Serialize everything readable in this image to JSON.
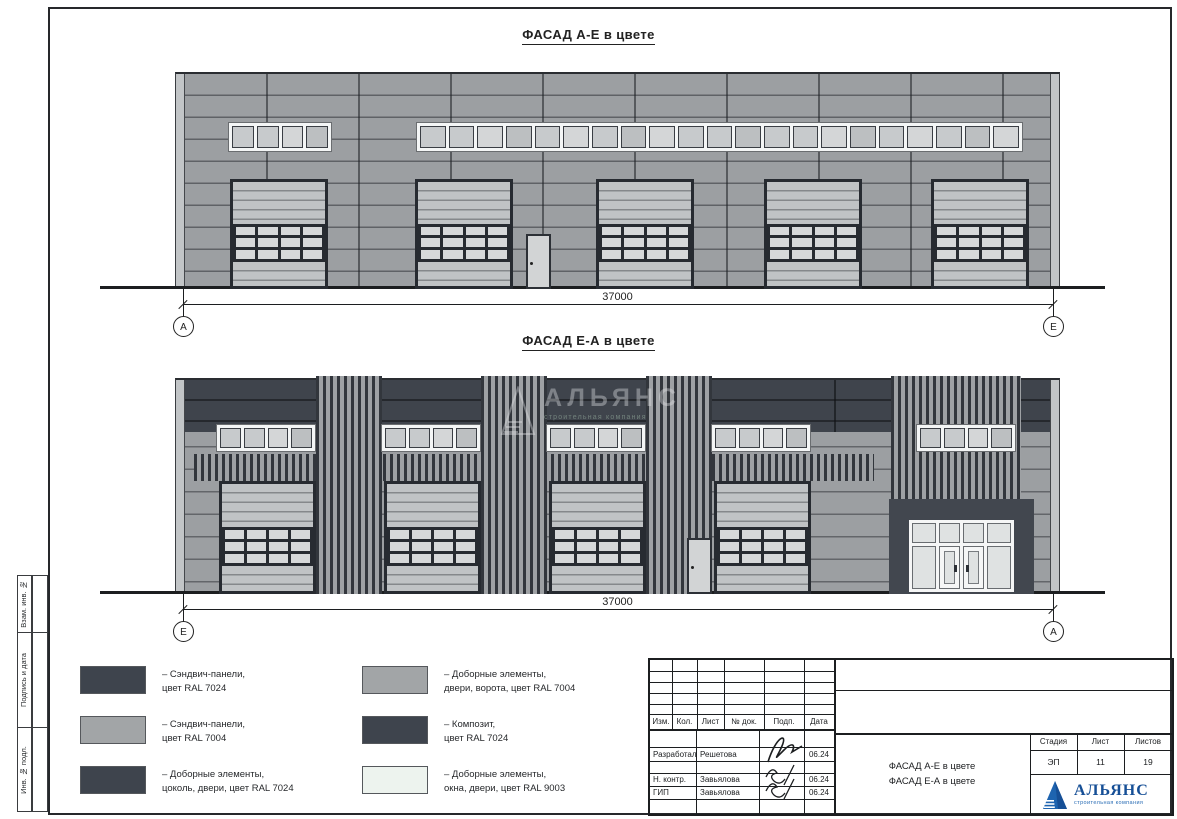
{
  "margin_labels": {
    "top": "Взам. инв. №",
    "mid": "Подпись и дата",
    "bot": "Инв. № подл."
  },
  "facade_top": {
    "title": "ФАСАД А-Е в цвете",
    "dimension": "37000",
    "axis_left": "А",
    "axis_right": "Е"
  },
  "facade_bottom": {
    "title": "ФАСАД Е-А в цвете",
    "dimension": "37000",
    "axis_left": "Е",
    "axis_right": "А"
  },
  "watermark": {
    "name": "АЛЬЯНС",
    "tagline": "строительная компания"
  },
  "legend": {
    "col1": [
      {
        "color": "#3e444d",
        "text": "– Сэндвич-панели,\nцвет RAL 7024"
      },
      {
        "color": "#a2a5a7",
        "text": "– Сэндвич-панели,\nцвет RAL 7004"
      },
      {
        "color": "#3e444d",
        "text": "– Доборные элементы,\nцоколь, двери, цвет RAL 7024"
      }
    ],
    "col2": [
      {
        "color": "#a2a5a7",
        "text": "– Доборные элементы,\nдвери, ворота, цвет RAL 7004"
      },
      {
        "color": "#3e444d",
        "text": "– Композит,\nцвет RAL 7024"
      },
      {
        "color": "#edf3ee",
        "text": "– Доборные элементы,\nокна, двери, цвет RAL 9003"
      }
    ]
  },
  "titleblock": {
    "cols": [
      "Изм.",
      "Кол.",
      "Лист",
      "№ док.",
      "Подп.",
      "Дата"
    ],
    "rows": [
      {
        "role": "Разработал",
        "name": "Решетова",
        "date": "06.24"
      },
      {
        "role": "Н. контр.",
        "name": "Завьялова",
        "date": "06.24"
      },
      {
        "role": "ГИП",
        "name": "Завьялова",
        "date": "06.24"
      }
    ],
    "doc_title_1": "ФАСАД А-Е в цвете",
    "doc_title_2": "ФАСАД Е-А в цвете",
    "stage_label": "Стадия",
    "stage_value": "ЭП",
    "sheet_label": "Лист",
    "sheet_value": "11",
    "sheets_label": "Листов",
    "sheets_value": "19",
    "company": {
      "name": "АЛЬЯНС",
      "tagline": "строительная компания"
    }
  },
  "colors": {
    "ral7024": "#3e444d",
    "ral7004": "#a2a5a7",
    "ral9003": "#edf3ee",
    "logo_blue": "#1c5fa8"
  }
}
